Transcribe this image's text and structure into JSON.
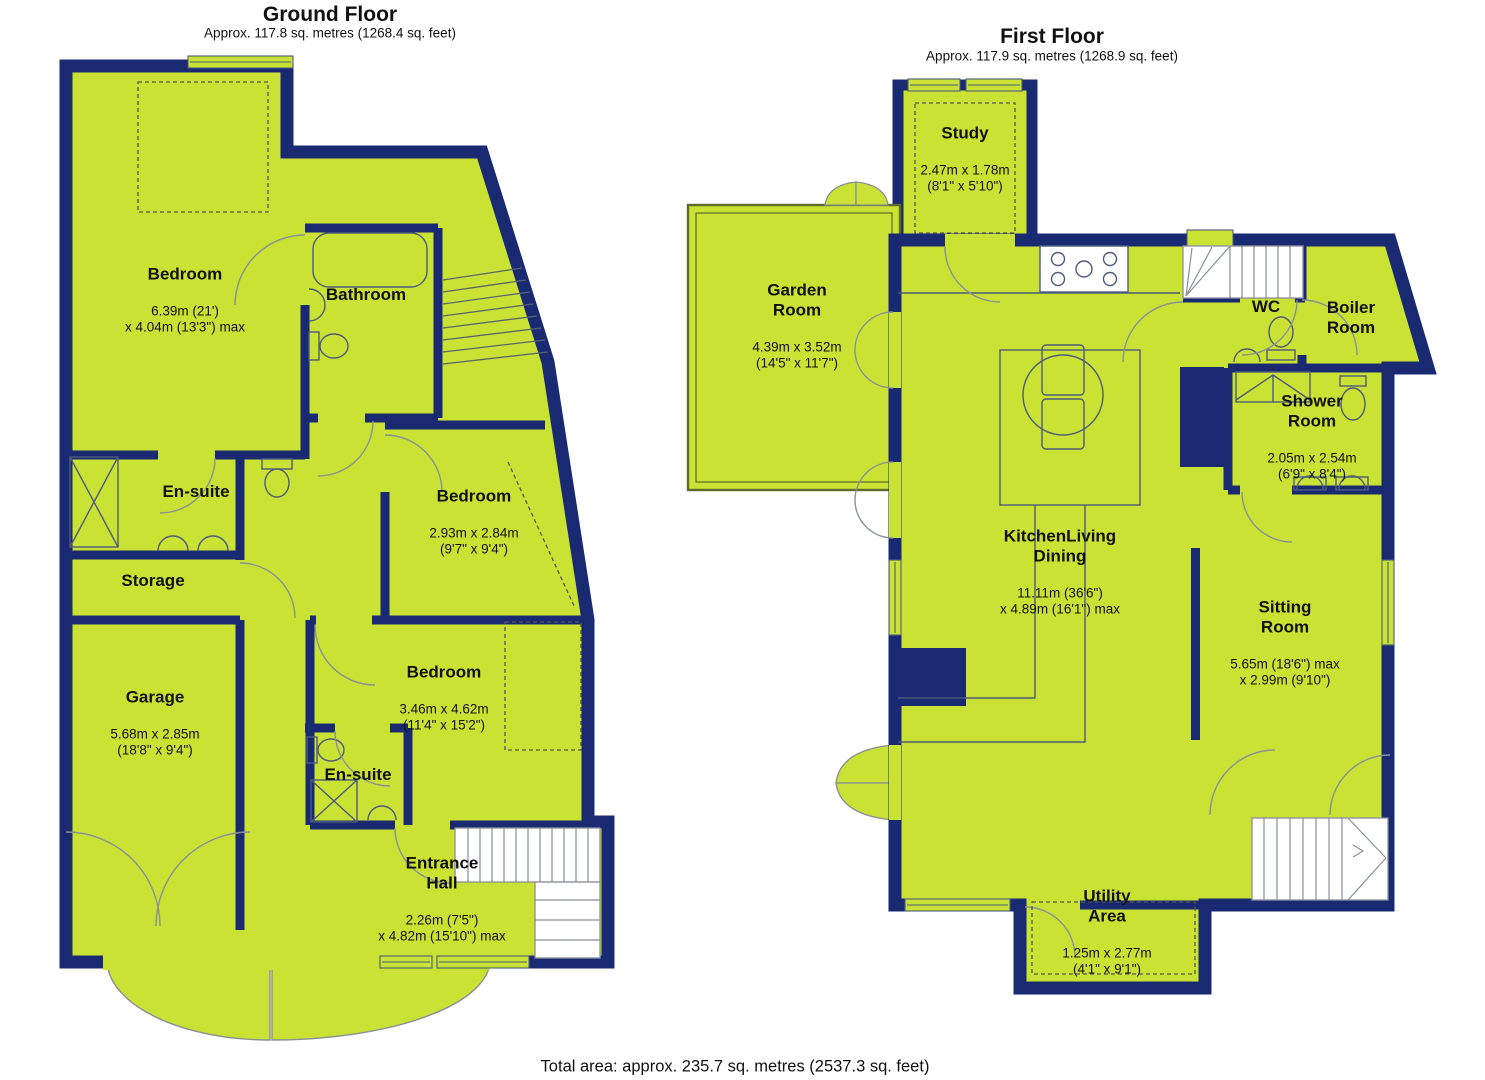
{
  "document": {
    "total_area": "Total area: approx. 235.7 sq. metres (2537.3 sq. feet)"
  },
  "colors": {
    "floor": "#c9e233",
    "wall": "#1a2a72"
  },
  "ground_floor": {
    "title": "Ground Floor",
    "subtitle": "Approx. 117.8 sq. metres (1268.4 sq. feet)",
    "rooms": [
      {
        "id": "bedroom-1",
        "name": "Bedroom",
        "dims": "6.39m (21')\nx 4.04m (13'3\") max"
      },
      {
        "id": "bathroom",
        "name": "Bathroom",
        "dims": ""
      },
      {
        "id": "en-suite-1",
        "name": "En-suite",
        "dims": ""
      },
      {
        "id": "bedroom-2",
        "name": "Bedroom",
        "dims": "2.93m x 2.84m\n(9'7\" x 9'4\")"
      },
      {
        "id": "storage",
        "name": "Storage",
        "dims": ""
      },
      {
        "id": "garage",
        "name": "Garage",
        "dims": "5.68m x 2.85m\n(18'8\" x 9'4\")"
      },
      {
        "id": "bedroom-3",
        "name": "Bedroom",
        "dims": "3.46m x 4.62m\n(11'4\" x 15'2\")"
      },
      {
        "id": "en-suite-2",
        "name": "En-suite",
        "dims": ""
      },
      {
        "id": "entrance-hall",
        "name": "Entrance\nHall",
        "dims": "2.26m (7'5\")\nx 4.82m (15'10\") max"
      }
    ]
  },
  "first_floor": {
    "title": "First Floor",
    "subtitle": "Approx. 117.9 sq. metres (1268.9 sq. feet)",
    "rooms": [
      {
        "id": "study",
        "name": "Study",
        "dims": "2.47m x 1.78m\n(8'1\" x 5'10\")"
      },
      {
        "id": "garden-room",
        "name": "Garden\nRoom",
        "dims": "4.39m x 3.52m\n(14'5\" x 11'7\")"
      },
      {
        "id": "wc",
        "name": "WC",
        "dims": ""
      },
      {
        "id": "boiler-room",
        "name": "Boiler\nRoom",
        "dims": ""
      },
      {
        "id": "shower-room",
        "name": "Shower\nRoom",
        "dims": "2.05m x 2.54m\n(6'9\" x 8'4\")"
      },
      {
        "id": "kitchen-living-dining",
        "name": "KitchenLiving\nDining",
        "dims": "11.11m (36'6\")\nx 4.89m (16'1\") max"
      },
      {
        "id": "sitting-room",
        "name": "Sitting\nRoom",
        "dims": "5.65m (18'6\") max\nx 2.99m (9'10\")"
      },
      {
        "id": "utility-area",
        "name": "Utility\nArea",
        "dims": "1.25m x 2.77m\n(4'1\" x 9'1\")"
      }
    ]
  }
}
